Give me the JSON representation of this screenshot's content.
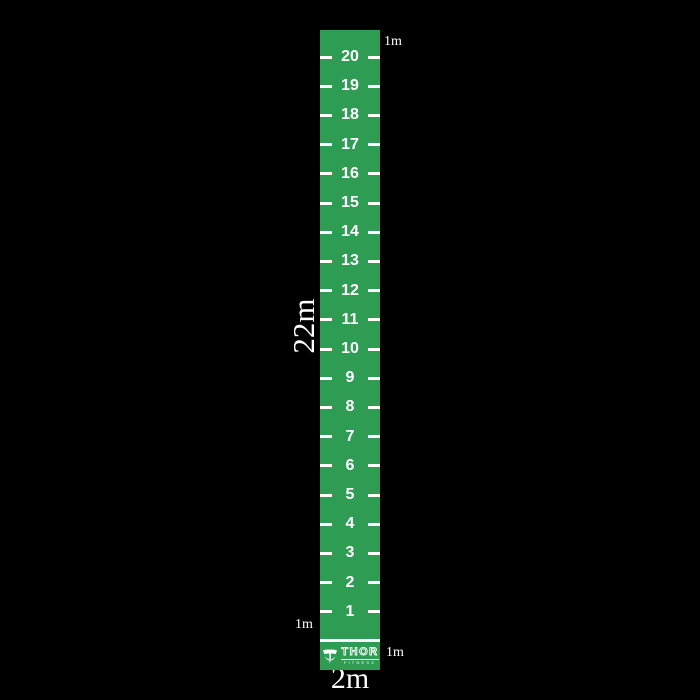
{
  "background_color": "#000000",
  "mat": {
    "color": "#2E9C53",
    "tick_color": "#FFFFFF",
    "length_label": "22m",
    "width_label": "2m",
    "top_meter_label": "1m",
    "bottom_left_meter_label": "1m",
    "bottom_right_meter_label": "1m",
    "numbers": [
      "20",
      "19",
      "18",
      "17",
      "16",
      "15",
      "14",
      "13",
      "12",
      "11",
      "10",
      "9",
      "8",
      "7",
      "6",
      "5",
      "4",
      "3",
      "2",
      "1"
    ],
    "logo": {
      "brand": "THOR",
      "subtext": "FITNESS"
    }
  }
}
